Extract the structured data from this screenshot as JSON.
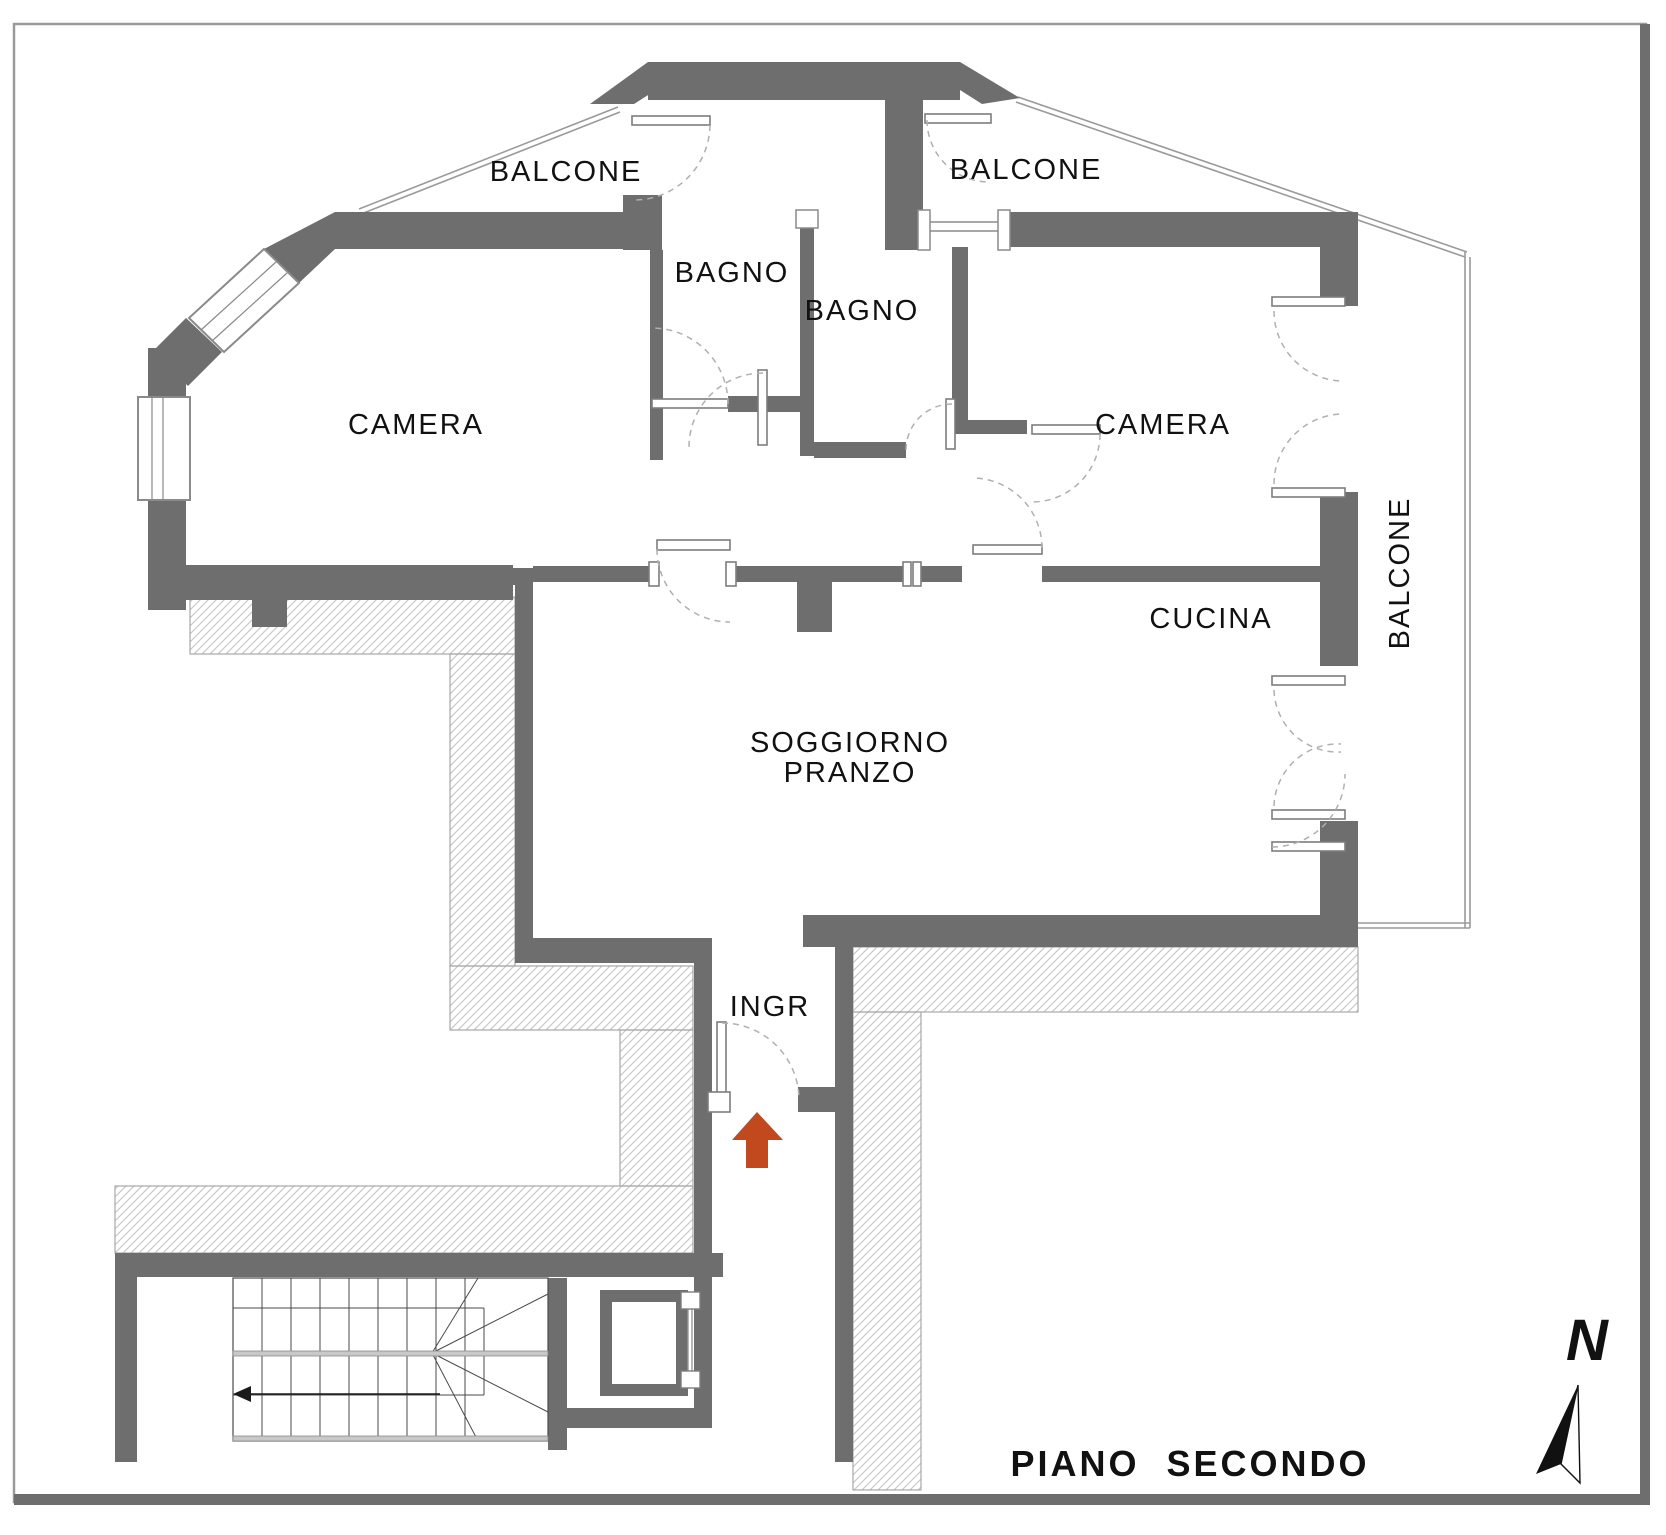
{
  "title": "PIANO SECONDO",
  "compass": {
    "north_label": "N"
  },
  "floor_plan": {
    "labels": {
      "balcone_top_left": "BALCONE",
      "balcone_top_right": "BALCONE",
      "balcone_right_side": "BALCONE",
      "bagno_left": "BAGNO",
      "bagno_right": "BAGNO",
      "camera_left": "CAMERA",
      "camera_right": "CAMERA",
      "cucina": "CUCINA",
      "soggiorno_line1": "SOGGIORNO",
      "soggiorno_line2": "PRANZO",
      "ingresso": "INGR"
    },
    "colors": {
      "wall": "#6e6e6e",
      "entrance_arrow": "#c2491d",
      "hatch_line": "#c9c9c9",
      "thin_line": "#9a9a9a",
      "paper": "#ffffff"
    }
  }
}
